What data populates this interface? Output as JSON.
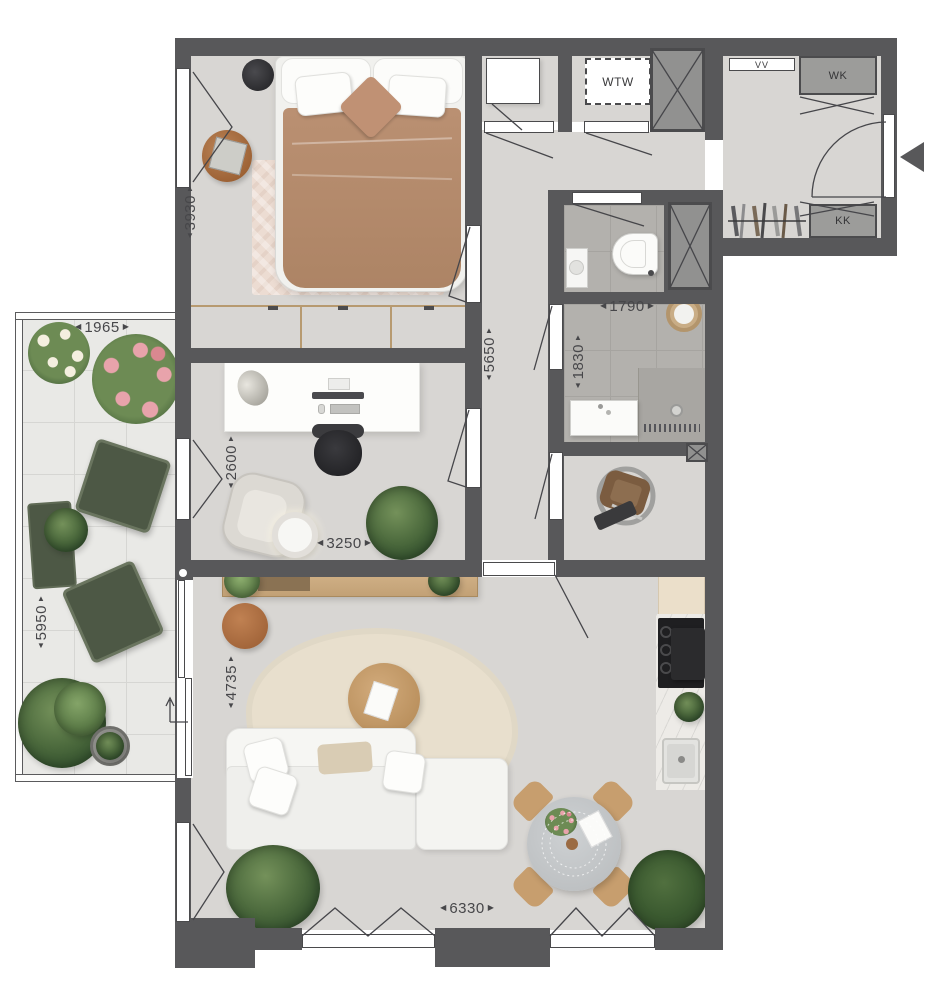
{
  "labels": {
    "wtw": "WTW",
    "vv": "VV",
    "wk": "WK",
    "kk": "KK"
  },
  "dimensions": {
    "bedroom_height": "3930",
    "balcony_width": "1965",
    "hallway_length": "5650",
    "bathroom_width": "1790",
    "bathroom_height": "1830",
    "office_height": "2600",
    "office_width": "3250",
    "balcony_height": "5950",
    "living_height": "4735",
    "living_width": "6330"
  },
  "icons": {
    "arrow_up": "▲",
    "arrow_down": "▼",
    "arrow_left": "◀",
    "arrow_right": "▶"
  },
  "colors": {
    "wall": "#58585a",
    "floor": "#d8d6d3",
    "bath_tile": "#b3b1ad",
    "balcony_tile": "#e9e9e6",
    "wood": "#d9bf99",
    "plant_green": "#4c6a3d"
  }
}
